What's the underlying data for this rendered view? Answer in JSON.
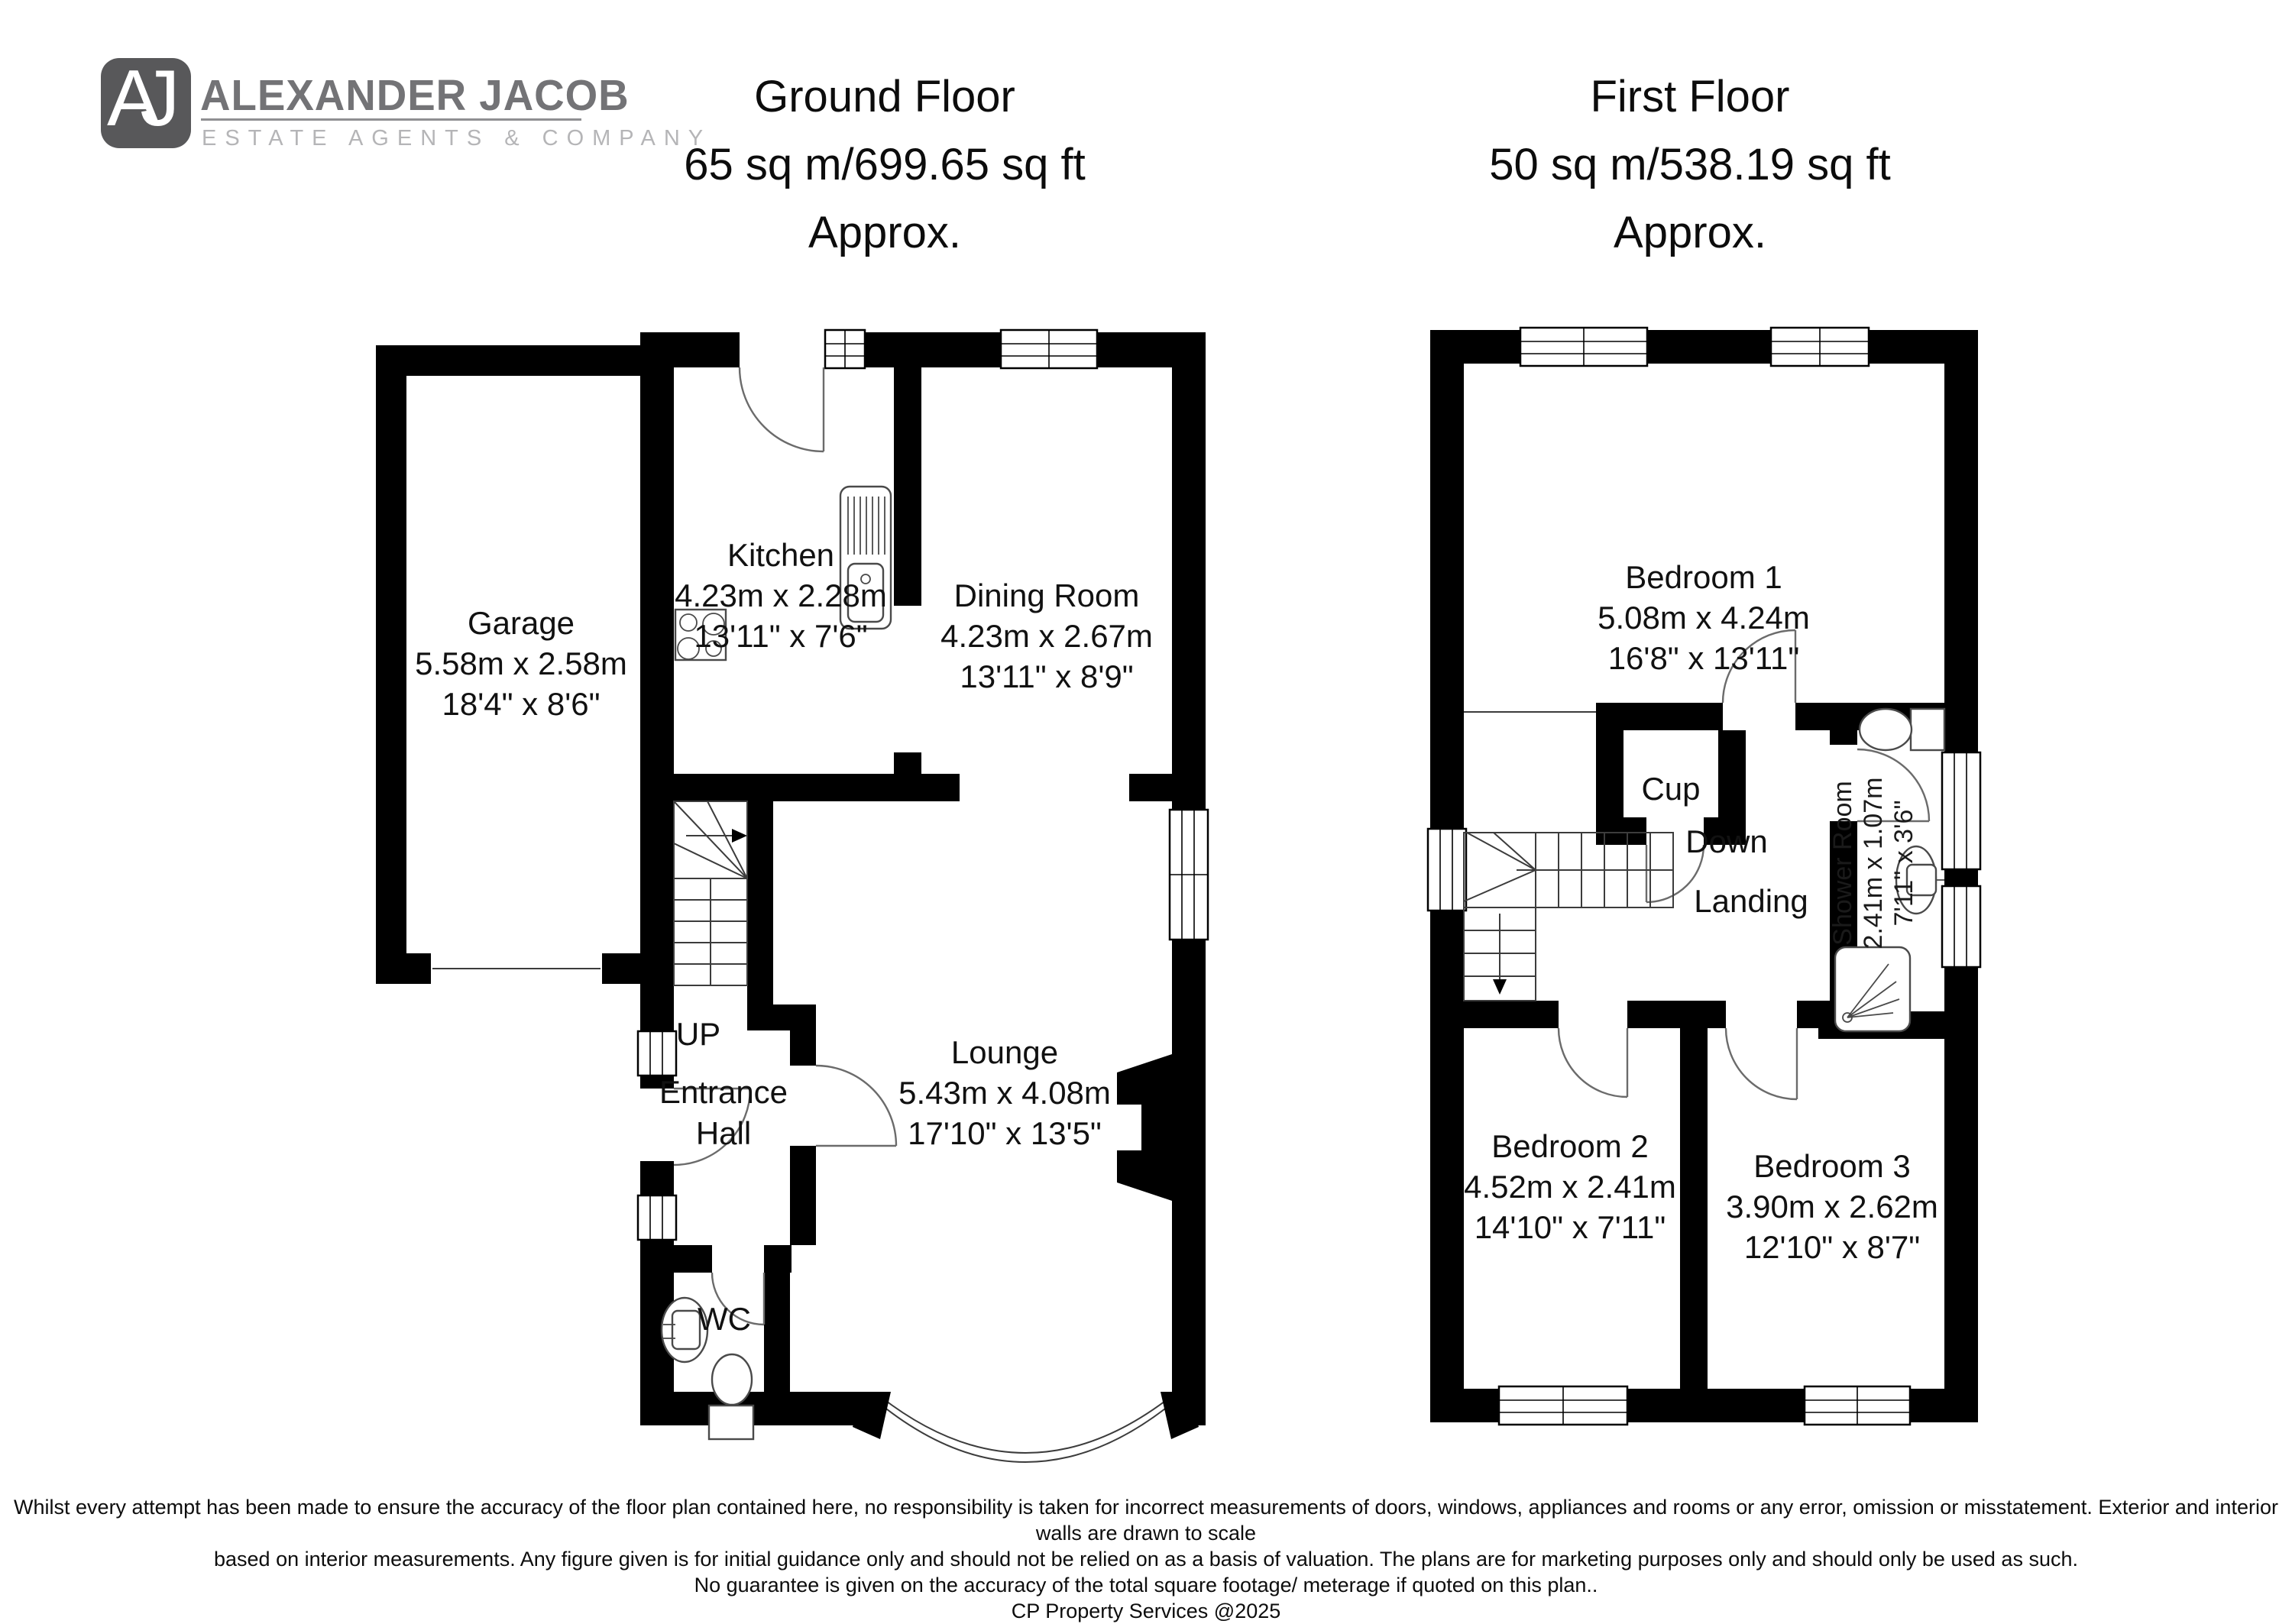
{
  "logo": {
    "initials": "AJ",
    "name": "ALEXANDER JACOB",
    "tagline": "ESTATE AGENTS & COMPANY"
  },
  "ground": {
    "title": [
      "Ground Floor",
      "65 sq m/699.65 sq ft",
      "Approx."
    ],
    "rooms": {
      "garage": {
        "name": "Garage",
        "metric": "5.58m x 2.58m",
        "imperial": "18'4\" x 8'6\""
      },
      "kitchen": {
        "name": "Kitchen",
        "metric": "4.23m x 2.28m",
        "imperial": "13'11\" x 7'6\""
      },
      "dining": {
        "name": "Dining Room",
        "metric": "4.23m x 2.67m",
        "imperial": "13'11\" x 8'9\""
      },
      "lounge": {
        "name": "Lounge",
        "metric": "5.43m x 4.08m",
        "imperial": "17'10\" x 13'5\""
      },
      "entrance_hall": {
        "name": "Entrance Hall"
      },
      "wc": {
        "name": "WC"
      },
      "up": "UP"
    }
  },
  "first": {
    "title": [
      "First Floor",
      "50 sq m/538.19 sq ft",
      "Approx."
    ],
    "rooms": {
      "bedroom1": {
        "name": "Bedroom 1",
        "metric": "5.08m x 4.24m",
        "imperial": "16'8\" x 13'11\""
      },
      "bedroom2": {
        "name": "Bedroom 2",
        "metric": "4.52m x 2.41m",
        "imperial": "14'10\" x 7'11\""
      },
      "bedroom3": {
        "name": "Bedroom 3",
        "metric": "3.90m x 2.62m",
        "imperial": "12'10\" x 8'7\""
      },
      "shower": {
        "name": "Shower Room",
        "metric": "2.41m x 1.07m",
        "imperial": "7'11\" x 3'6\""
      },
      "cup": {
        "name": "Cup"
      },
      "landing": {
        "name": "Landing"
      },
      "down": "Down"
    }
  },
  "footer": {
    "lines": [
      "Whilst every attempt has been made to ensure the accuracy of the floor plan contained here, no responsibility is taken for incorrect measurements of doors, windows, appliances and rooms or any error, omission or misstatement. Exterior and interior walls are drawn to scale",
      "based on interior measurements. Any figure given is for initial guidance only and should not be relied on as a basis of valuation. The plans are for marketing purposes only and should only be used as such.",
      "No guarantee is given on the accuracy of the total square footage/ meterage if quoted on this plan..",
      "CP Property Services @2025"
    ]
  }
}
